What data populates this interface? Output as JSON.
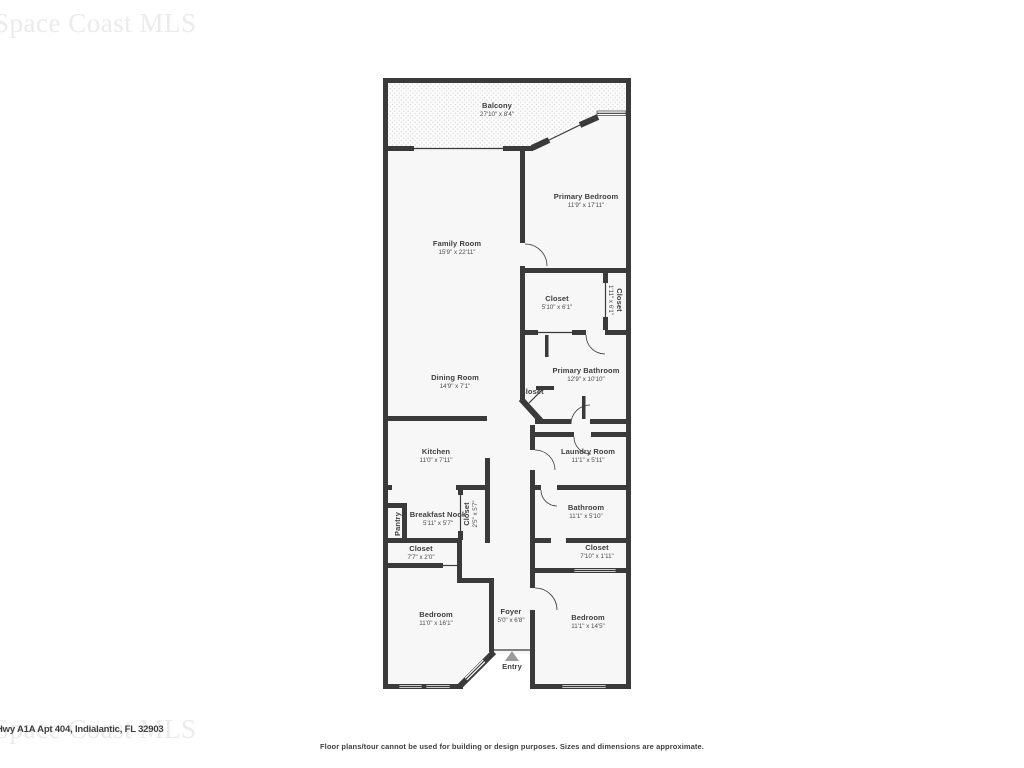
{
  "colors": {
    "wall": "#3a3a3a",
    "room_fill": "#f7f7f7",
    "balcony_bg": "#fcfcfc",
    "balcony_dot": "#d8d8d8",
    "label": "#3e3e3e",
    "dims": "#4b4b4b",
    "watermark": "#ebebeb",
    "text_dark": "#3f3f3f",
    "entry_arrow": "#9a9a9a"
  },
  "watermark": {
    "text": "Space Coast MLS"
  },
  "address": "Hwy A1A Apt 404, Indialantic, FL 32903",
  "disclaimer": "Floor plans/tour cannot be used for building or design purposes. Sizes and dimensions are approximate.",
  "entry_label": "Entry",
  "rooms": [
    {
      "id": "balcony",
      "name": "Balcony",
      "dims": "27'10\" x 8'4\""
    },
    {
      "id": "primary-bedroom",
      "name": "Primary Bedroom",
      "dims": "11'9\" x 17'11\""
    },
    {
      "id": "family-room",
      "name": "Family Room",
      "dims": "15'9\" x 22'11\""
    },
    {
      "id": "closet-primary",
      "name": "Closet",
      "dims": "5'10\" x 6'1\""
    },
    {
      "id": "closet-primary-2",
      "name": "Closet",
      "dims": "1'11\" x 6'1\""
    },
    {
      "id": "primary-bathroom",
      "name": "Primary Bathroom",
      "dims": "12'9\" x 10'10\""
    },
    {
      "id": "dining-room",
      "name": "Dining Room",
      "dims": "14'9\" x 7'1\""
    },
    {
      "id": "closet-hall",
      "name": "Closet",
      "dims": ""
    },
    {
      "id": "kitchen",
      "name": "Kitchen",
      "dims": "11'0\" x 7'11\""
    },
    {
      "id": "laundry-room",
      "name": "Laundry Room",
      "dims": "11'1\" x 5'11\""
    },
    {
      "id": "breakfast-nook",
      "name": "Breakfast Nook",
      "dims": "5'11\" x 5'7\""
    },
    {
      "id": "closet-breakfast",
      "name": "Closet",
      "dims": "2'5\" x 5'7\""
    },
    {
      "id": "pantry",
      "name": "Pantry",
      "dims": ""
    },
    {
      "id": "bathroom",
      "name": "Bathroom",
      "dims": "11'1\" x 5'10\""
    },
    {
      "id": "closet-bedroom-left",
      "name": "Closet",
      "dims": "7'7\" x 2'0\""
    },
    {
      "id": "closet-bedroom-right",
      "name": "Closet",
      "dims": "7'10\" x 1'11\""
    },
    {
      "id": "bedroom-left",
      "name": "Bedroom",
      "dims": "11'0\" x 16'1\""
    },
    {
      "id": "foyer",
      "name": "Foyer",
      "dims": "5'0\" x 6'8\""
    },
    {
      "id": "bedroom-right",
      "name": "Bedroom",
      "dims": "11'1\" x 14'5\""
    }
  ]
}
